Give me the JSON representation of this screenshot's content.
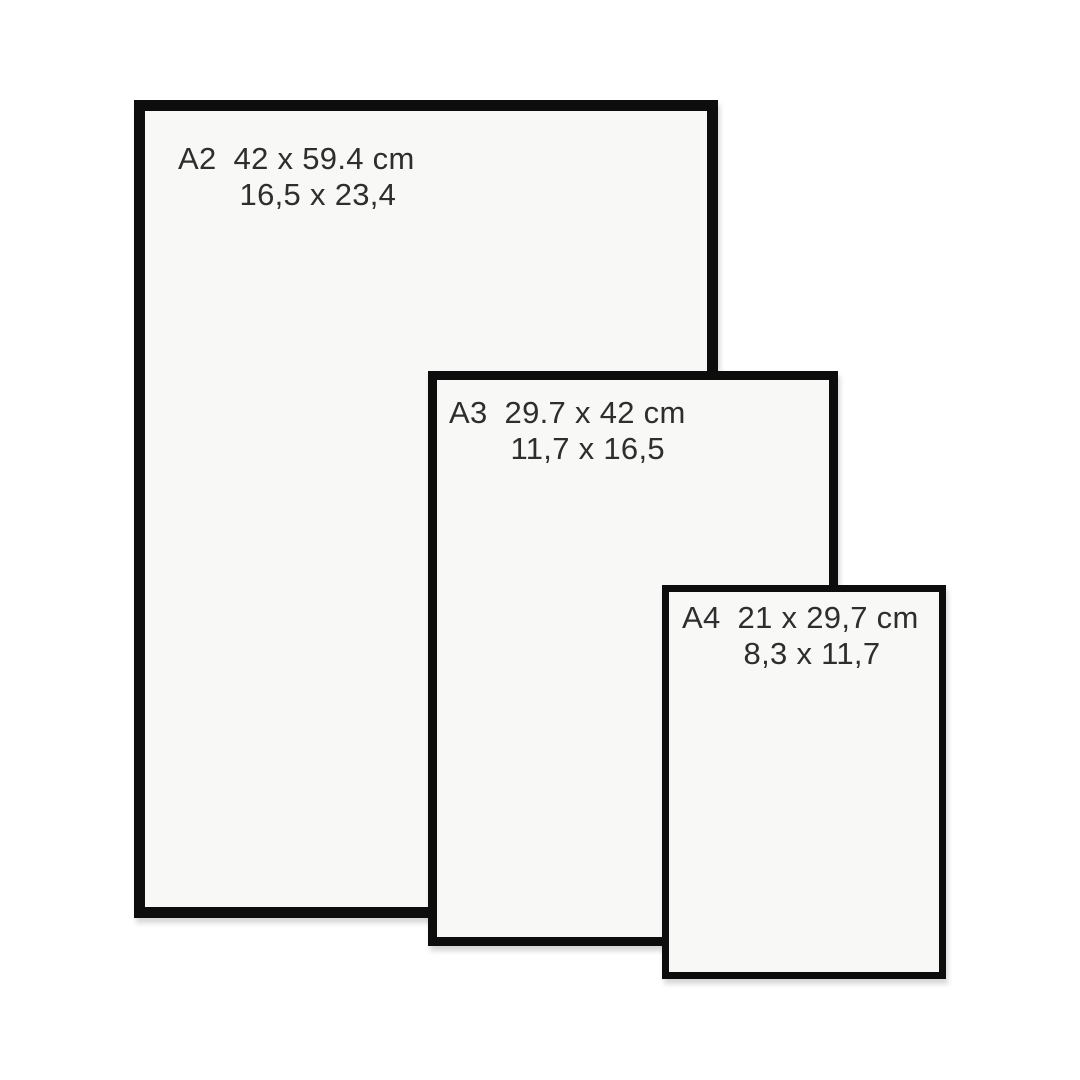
{
  "colors": {
    "bg": "#ffffff",
    "frame": "#0d0d0d",
    "paper": "#f8f8f7",
    "text": "#2e2e2e"
  },
  "frames": [
    {
      "code": "A2",
      "dimensions_cm": "42 x 59.4 cm",
      "dimensions_in": "16,5 x 23,4"
    },
    {
      "code": "A3",
      "dimensions_cm": "29.7 x 42 cm",
      "dimensions_in": "11,7 x 16,5"
    },
    {
      "code": "A4",
      "dimensions_cm": "21 x 29,7 cm",
      "dimensions_in": "8,3 x 11,7"
    }
  ]
}
